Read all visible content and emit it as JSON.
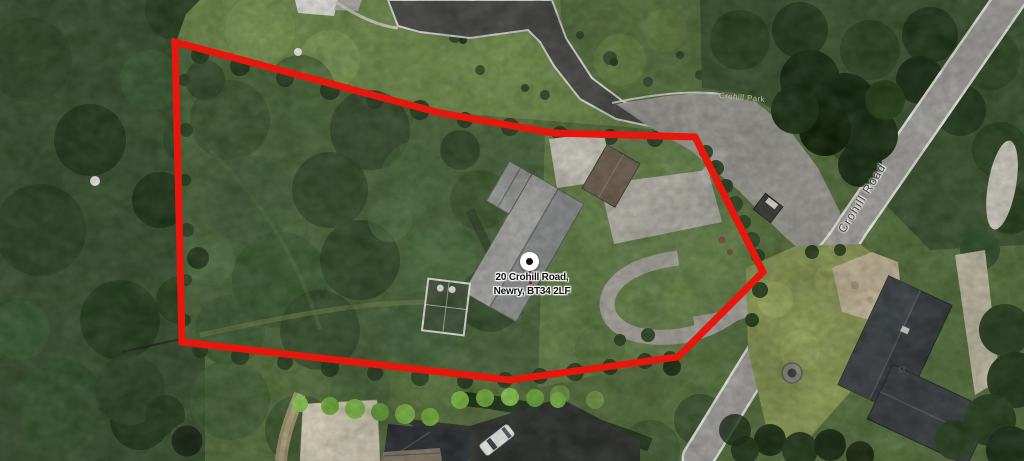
{
  "map": {
    "marker": {
      "address_line1": "20 Crohill Road,",
      "address_line2": "Newry, BT34 2LF"
    },
    "labels": {
      "road": "Crohill Road",
      "side_road": "Crohill Park",
      "house_number": "17"
    },
    "boundary": {
      "color": "#e8170e",
      "points_svg": "175,42 440,113 553,133 695,137 763,272 678,357 510,380 182,342"
    }
  }
}
